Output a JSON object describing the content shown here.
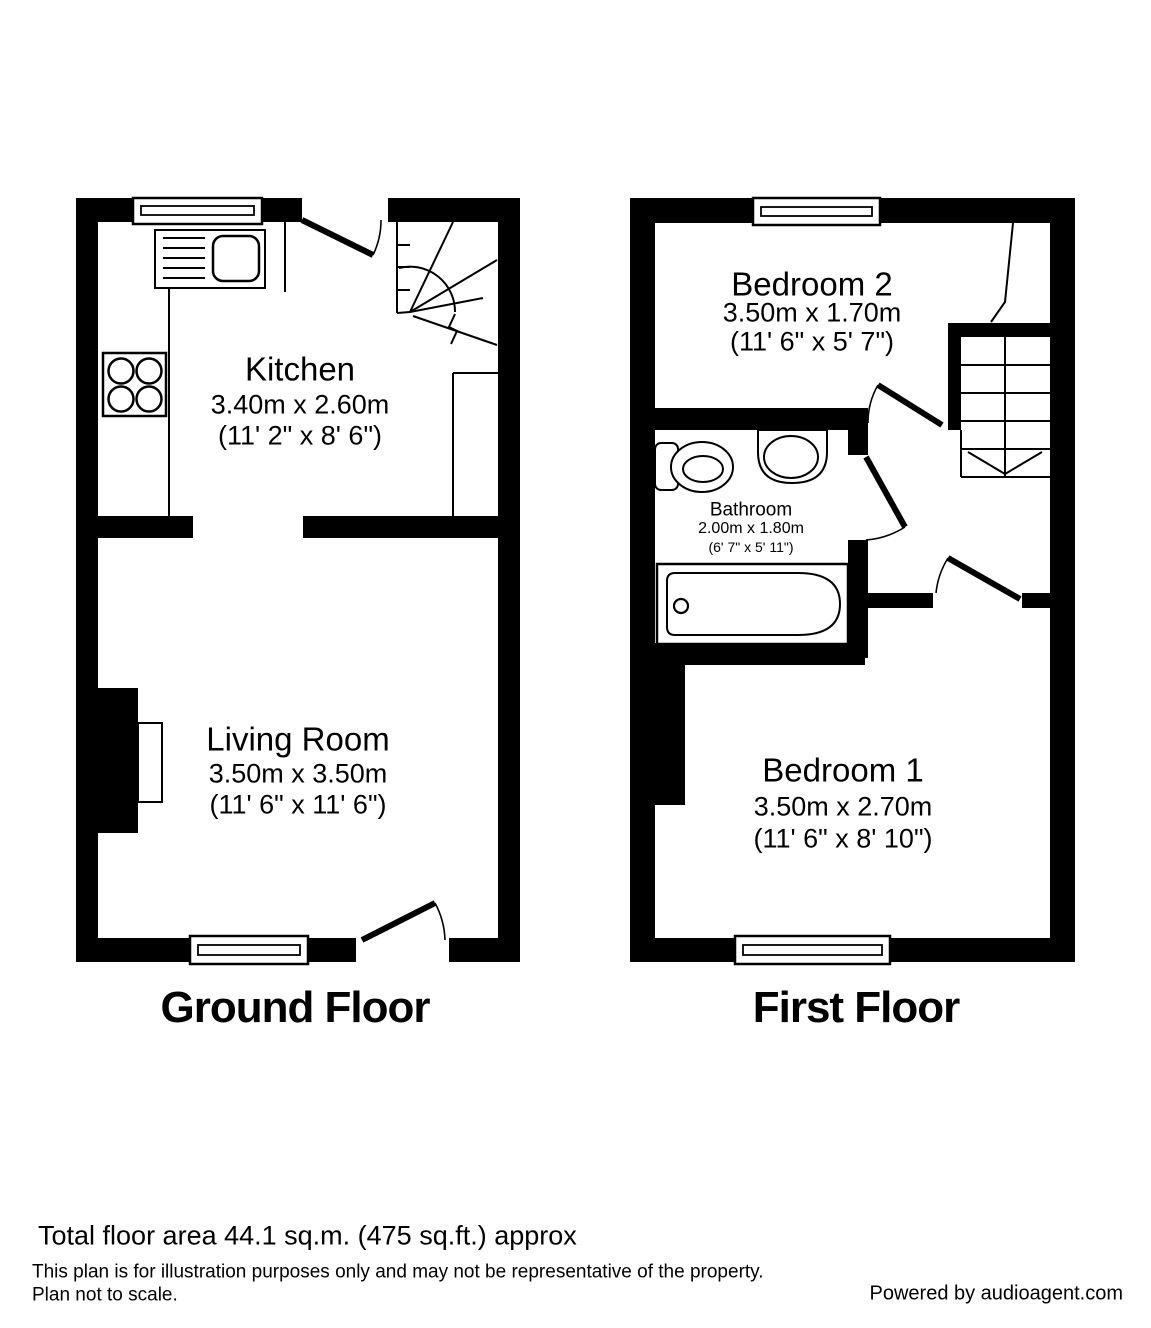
{
  "ground_floor": {
    "title": "Ground Floor",
    "rooms": {
      "kitchen": {
        "name": "Kitchen",
        "metric": "3.40m x 2.60m",
        "imperial": "(11' 2\" x 8' 6\")"
      },
      "living_room": {
        "name": "Living Room",
        "metric": "3.50m x 3.50m",
        "imperial": "(11' 6\" x 11' 6\")"
      }
    }
  },
  "first_floor": {
    "title": "First Floor",
    "rooms": {
      "bedroom2": {
        "name": "Bedroom 2",
        "metric": "3.50m x 1.70m",
        "imperial": "(11' 6\" x 5' 7\")"
      },
      "bathroom": {
        "name": "Bathroom",
        "metric": "2.00m x 1.80m",
        "imperial": "(6' 7\" x 5' 11\")"
      },
      "bedroom1": {
        "name": "Bedroom 1",
        "metric": "3.50m x 2.70m",
        "imperial": "(11' 6\" x 8' 10\")"
      }
    }
  },
  "footer": {
    "total_area": "Total floor area 44.1 sq.m. (475 sq.ft.) approx",
    "disclaimer_line1": "This plan is for illustration purposes only and may not be representative of the property.",
    "disclaimer_line2": "Plan not to scale.",
    "credit": "Powered by audioagent.com"
  },
  "colors": {
    "wall": "#000000",
    "background": "#ffffff"
  }
}
